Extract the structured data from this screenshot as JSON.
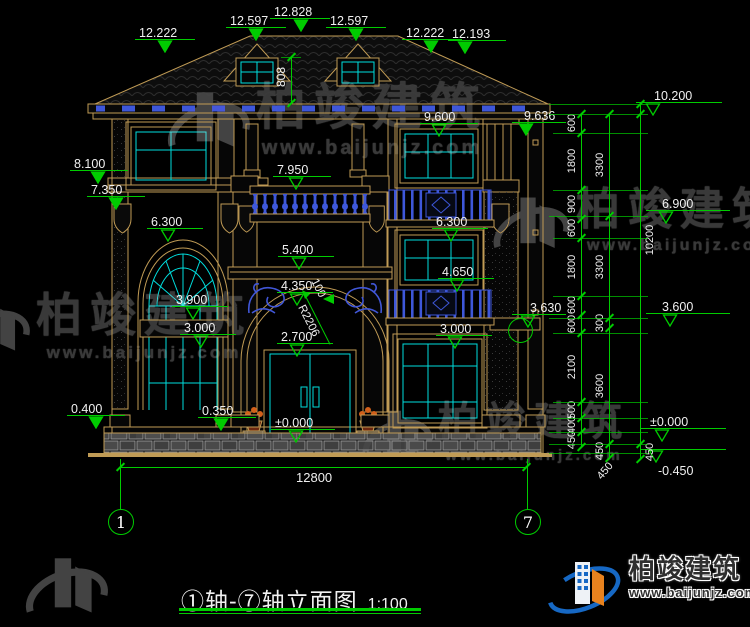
{
  "title": {
    "text": "①轴-⑦轴立面图",
    "scale": "1:100"
  },
  "axis_bubbles": [
    {
      "label": "1",
      "x": 108,
      "y": 509
    },
    {
      "label": "7",
      "x": 515,
      "y": 509
    }
  ],
  "watermark": {
    "brand": "柏竣建筑",
    "url": "www.baijunjz.com"
  },
  "logo": {
    "brand": "柏竣建筑",
    "url": "www.baijunjz.com"
  },
  "colors": {
    "dim_green": "#00cc00",
    "cad_tan": "#c09b55",
    "cad_cyan": "#00dede",
    "cad_blue": "#3e57d9",
    "text_white": "#f0f0f0",
    "logo_blue": "#1668c4",
    "logo_orange": "#e8821e",
    "watermark_gray": "#3c3c3c"
  },
  "dims": {
    "overall": "12800",
    "dormer_height": "808",
    "arch_radius": "R2206",
    "arch_gap": "100"
  },
  "markers": [
    {
      "v": "12.222",
      "x": 139,
      "y": 26,
      "lx": 135,
      "ly": 39,
      "lw": 60,
      "tx": 157,
      "ty": 40,
      "st": "f"
    },
    {
      "v": "12.597",
      "x": 230,
      "y": 14,
      "lx": 226,
      "ly": 27,
      "lw": 60,
      "tx": 248,
      "ty": 28,
      "st": "f"
    },
    {
      "v": "12.828",
      "x": 274,
      "y": 5,
      "lx": 270,
      "ly": 18,
      "lw": 60,
      "tx": 293,
      "ty": 19,
      "st": "f"
    },
    {
      "v": "12.597",
      "x": 330,
      "y": 14,
      "lx": 326,
      "ly": 27,
      "lw": 60,
      "tx": 348,
      "ty": 28,
      "st": "f"
    },
    {
      "v": "12.222",
      "x": 406,
      "y": 26,
      "lx": 402,
      "ly": 39,
      "lw": 60,
      "tx": 423,
      "ty": 40,
      "st": "f"
    },
    {
      "v": "12.193",
      "x": 452,
      "y": 27,
      "lx": 448,
      "ly": 40,
      "lw": 58,
      "tx": 457,
      "ty": 41,
      "st": "f"
    },
    {
      "v": "8.100",
      "x": 74,
      "y": 157,
      "lx": 70,
      "ly": 170,
      "lw": 58,
      "tx": 90,
      "ty": 171,
      "st": "f"
    },
    {
      "v": "7.350",
      "x": 91,
      "y": 183,
      "lx": 87,
      "ly": 196,
      "lw": 58,
      "tx": 108,
      "ty": 197,
      "st": "f"
    },
    {
      "v": "6.300",
      "x": 151,
      "y": 215,
      "lx": 147,
      "ly": 228,
      "lw": 56,
      "tx": 160,
      "ty": 229,
      "st": "o"
    },
    {
      "v": "3.900",
      "x": 176,
      "y": 293,
      "lx": 172,
      "ly": 306,
      "lw": 56,
      "tx": 185,
      "ty": 307,
      "st": "o"
    },
    {
      "v": "3.000",
      "x": 184,
      "y": 321,
      "lx": 180,
      "ly": 334,
      "lw": 56,
      "tx": 193,
      "ty": 335,
      "st": "o"
    },
    {
      "v": "0.400",
      "x": 71,
      "y": 402,
      "lx": 67,
      "ly": 415,
      "lw": 58,
      "tx": 88,
      "ty": 416,
      "st": "f"
    },
    {
      "v": "0.350",
      "x": 202,
      "y": 404,
      "lx": 198,
      "ly": 417,
      "lw": 58,
      "tx": 213,
      "ty": 418,
      "st": "f"
    },
    {
      "v": "9.600",
      "x": 424,
      "y": 110,
      "lx": 420,
      "ly": 123,
      "lw": 58,
      "tx": 431,
      "ty": 124,
      "st": "o"
    },
    {
      "v": "9.636",
      "x": 524,
      "y": 109,
      "lx": 512,
      "ly": 122,
      "lw": 54,
      "tx": 518,
      "ty": 123,
      "st": "f"
    },
    {
      "v": "7.950",
      "x": 277,
      "y": 163,
      "lx": 273,
      "ly": 176,
      "lw": 58,
      "tx": 288,
      "ty": 177,
      "st": "o"
    },
    {
      "v": "6.300",
      "x": 436,
      "y": 215,
      "lx": 432,
      "ly": 228,
      "lw": 56,
      "tx": 443,
      "ty": 229,
      "st": "o"
    },
    {
      "v": "5.400",
      "x": 282,
      "y": 243,
      "lx": 278,
      "ly": 256,
      "lw": 56,
      "tx": 291,
      "ty": 257,
      "st": "o"
    },
    {
      "v": "4.350",
      "x": 281,
      "y": 279,
      "lx": 277,
      "ly": 292,
      "lw": 56,
      "tx": 289,
      "ty": 293,
      "st": "o"
    },
    {
      "v": "4.650",
      "x": 442,
      "y": 265,
      "lx": 438,
      "ly": 278,
      "lw": 56,
      "tx": 449,
      "ty": 279,
      "st": "o"
    },
    {
      "v": "3.000",
      "x": 440,
      "y": 322,
      "lx": 436,
      "ly": 335,
      "lw": 56,
      "tx": 447,
      "ty": 336,
      "st": "o"
    },
    {
      "v": "2.700",
      "x": 281,
      "y": 330,
      "lx": 277,
      "ly": 343,
      "lw": 56,
      "tx": 289,
      "ty": 344,
      "st": "o"
    },
    {
      "v": "±0.000",
      "x": 275,
      "y": 416,
      "lx": 271,
      "ly": 429,
      "lw": 64,
      "tx": 288,
      "ty": 430,
      "st": "o"
    },
    {
      "v": "3.630",
      "x": 530,
      "y": 301,
      "lx": 512,
      "ly": 314,
      "lw": 54,
      "tx": 520,
      "ty": 315,
      "st": "o"
    },
    {
      "v": "10.200",
      "x": 654,
      "y": 89,
      "lx": 636,
      "ly": 102,
      "lw": 86,
      "tx": 645,
      "ty": 103,
      "st": "o"
    },
    {
      "v": "6.900",
      "x": 662,
      "y": 197,
      "lx": 646,
      "ly": 210,
      "lw": 84,
      "tx": 658,
      "ty": 211,
      "st": "o"
    },
    {
      "v": "3.600",
      "x": 662,
      "y": 300,
      "lx": 646,
      "ly": 313,
      "lw": 84,
      "tx": 662,
      "ty": 314,
      "st": "o"
    },
    {
      "v": "±0.000",
      "x": 650,
      "y": 415,
      "lx": 640,
      "ly": 428,
      "lw": 86,
      "tx": 654,
      "ty": 429,
      "st": "o"
    },
    {
      "v": "-0.450",
      "x": 658,
      "y": 464,
      "lx": 640,
      "ly": 449,
      "lw": 86,
      "tx": 648,
      "ty": 450,
      "st": "o"
    }
  ],
  "circle_markers": [
    {
      "x": 508,
      "y": 318,
      "d": 23
    }
  ],
  "chains": [
    {
      "x": 581,
      "lx": 572,
      "y1": 114,
      "y2": 447,
      "ticks": [
        114,
        133,
        190,
        219,
        238,
        296,
        315,
        333,
        402,
        418,
        432,
        447
      ],
      "labels": [
        [
          "600",
          123
        ],
        [
          "1800",
          161
        ],
        [
          "900",
          204
        ],
        [
          "600",
          228
        ],
        [
          "1800",
          267
        ],
        [
          "600",
          305
        ],
        [
          "600",
          324
        ],
        [
          "2100",
          367
        ],
        [
          "500",
          410
        ],
        [
          "400",
          425
        ],
        [
          "450",
          440
        ]
      ]
    },
    {
      "x": 609,
      "lx": 600,
      "y1": 114,
      "y2": 458,
      "ticks": [
        114,
        216,
        318,
        328,
        444,
        458
      ],
      "labels": [
        [
          "3300",
          165
        ],
        [
          "3300",
          267
        ],
        [
          "300",
          323
        ],
        [
          "3600",
          386
        ],
        [
          "450",
          451
        ]
      ]
    },
    {
      "x": 640,
      "lx": 650,
      "y1": 104,
      "y2": 459,
      "ticks": [
        104,
        114,
        444,
        459
      ],
      "labels": [
        [
          "10200",
          240
        ],
        [
          "450",
          452
        ]
      ]
    }
  ],
  "diag_labels": [
    {
      "v": "450",
      "x": 596,
      "y": 465,
      "r": -50
    }
  ],
  "ext_lines": [
    {
      "y": 104,
      "x1": 549,
      "x2": 648
    },
    {
      "y": 114,
      "x1": 549,
      "x2": 648
    },
    {
      "y": 133,
      "x1": 553,
      "x2": 648
    },
    {
      "y": 190,
      "x1": 553,
      "x2": 648
    },
    {
      "y": 216,
      "x1": 549,
      "x2": 648
    },
    {
      "y": 238,
      "x1": 553,
      "x2": 648
    },
    {
      "y": 296,
      "x1": 553,
      "x2": 648
    },
    {
      "y": 318,
      "x1": 549,
      "x2": 648
    },
    {
      "y": 333,
      "x1": 553,
      "x2": 648
    },
    {
      "y": 402,
      "x1": 553,
      "x2": 648
    },
    {
      "y": 418,
      "x1": 553,
      "x2": 648
    },
    {
      "y": 432,
      "x1": 549,
      "x2": 648
    },
    {
      "y": 444,
      "x1": 549,
      "x2": 648
    },
    {
      "y": 453,
      "x1": 549,
      "x2": 648
    }
  ],
  "overall_dim": {
    "line_y": 467,
    "x1": 120,
    "x2": 527,
    "label_x": 296,
    "label_y": 470
  },
  "watermark_instances": [
    {
      "x": 160,
      "y": 82,
      "s": 50,
      "logo": 92,
      "url_s": 20
    },
    {
      "x": -52,
      "y": 292,
      "s": 46,
      "logo": 84,
      "url_s": 17
    },
    {
      "x": 486,
      "y": 188,
      "s": 44,
      "logo": 86,
      "url_s": 16
    },
    {
      "x": 356,
      "y": 402,
      "s": 40,
      "logo": 78,
      "url_s": 15
    },
    {
      "x": 18,
      "y": 548,
      "s": 0,
      "logo": 92,
      "url_s": 0
    }
  ]
}
